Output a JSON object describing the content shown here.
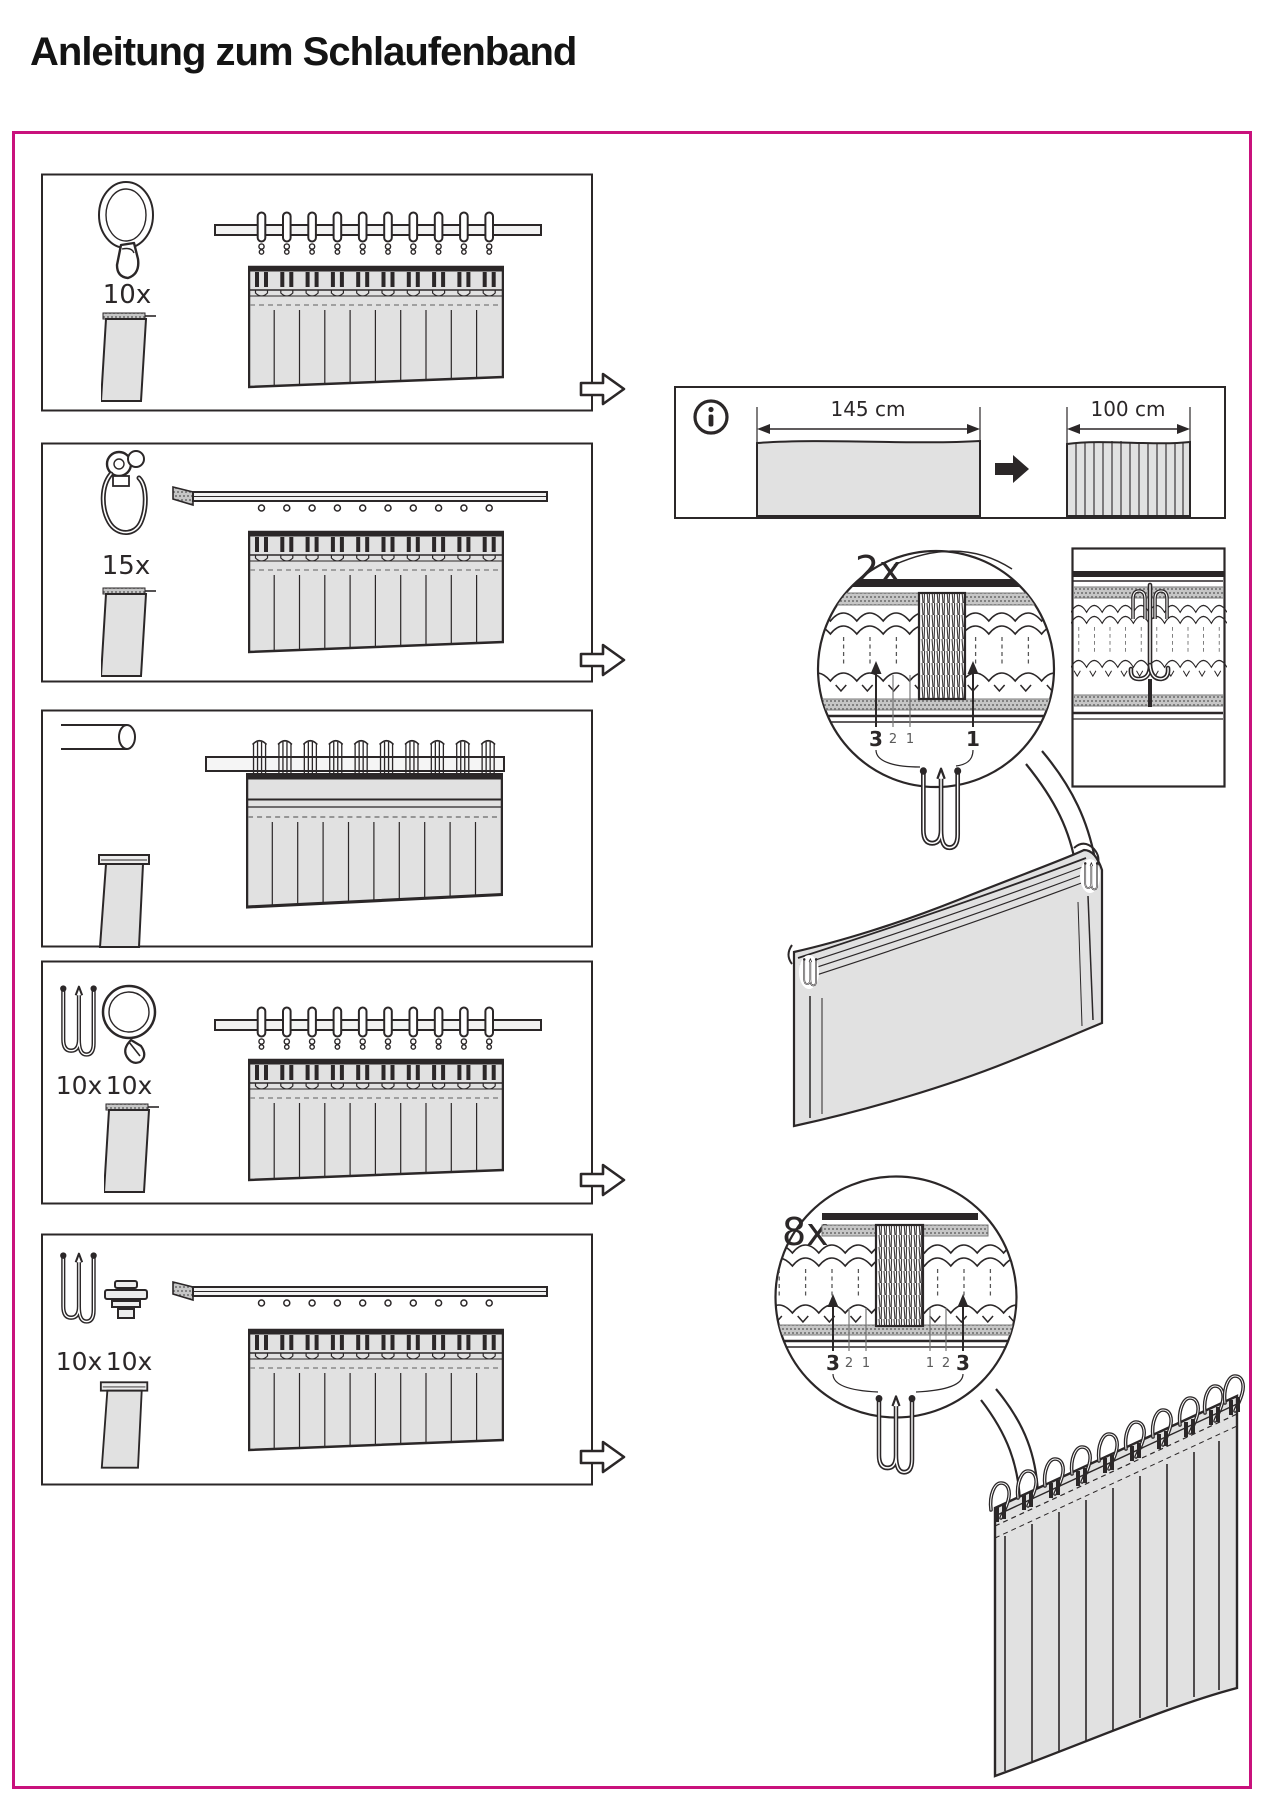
{
  "page": {
    "title": "Anleitung zum Schlaufenband"
  },
  "colors": {
    "accent_pink": "#C9117C",
    "fabric_grey": "#E1E1E1",
    "line_dark": "#2B2728"
  },
  "steps": [
    {
      "name": "step-1-clip-rings",
      "counts": [
        "10x"
      ],
      "icons": [
        "clip-ring-icon",
        "fabric-strip-icon"
      ],
      "hanging_diagram": "rod-with-clip-rings"
    },
    {
      "name": "step-2-track-gliders",
      "counts": [
        "15x"
      ],
      "icons": [
        "track-glider-icon",
        "fabric-strip-icon"
      ],
      "hanging_diagram": "track-with-gliders"
    },
    {
      "name": "step-3-rod",
      "counts": [],
      "icons": [
        "rod-icon",
        "fabric-strip-icon"
      ],
      "hanging_diagram": "rod-through-loops"
    },
    {
      "name": "step-4-hooks-rings",
      "counts": [
        "10x",
        "10x"
      ],
      "icons": [
        "pleat-hook-icon",
        "ring-hook-icon",
        "fabric-strip-icon"
      ],
      "hanging_diagram": "rod-with-rings-and-hooks"
    },
    {
      "name": "step-5-hooks-gliders",
      "counts": [
        "10x",
        "10x"
      ],
      "icons": [
        "pleat-hook-icon",
        "glider-foot-icon",
        "fabric-strip-icon"
      ],
      "hanging_diagram": "track-with-gliders-and-hooks"
    }
  ],
  "info_box": {
    "icon": "info-icon",
    "flat_width": "145 cm",
    "gathered_width": "100 cm"
  },
  "details": {
    "top": {
      "multiplier": "2x",
      "pocket_labels_left": [
        "3",
        "2",
        "1"
      ],
      "pocket_labels_right": [
        "1"
      ]
    },
    "bottom": {
      "multiplier": "8x",
      "pocket_labels_left": [
        "3",
        "2",
        "1"
      ],
      "pocket_labels_right": [
        "1",
        "2",
        "3"
      ]
    }
  }
}
